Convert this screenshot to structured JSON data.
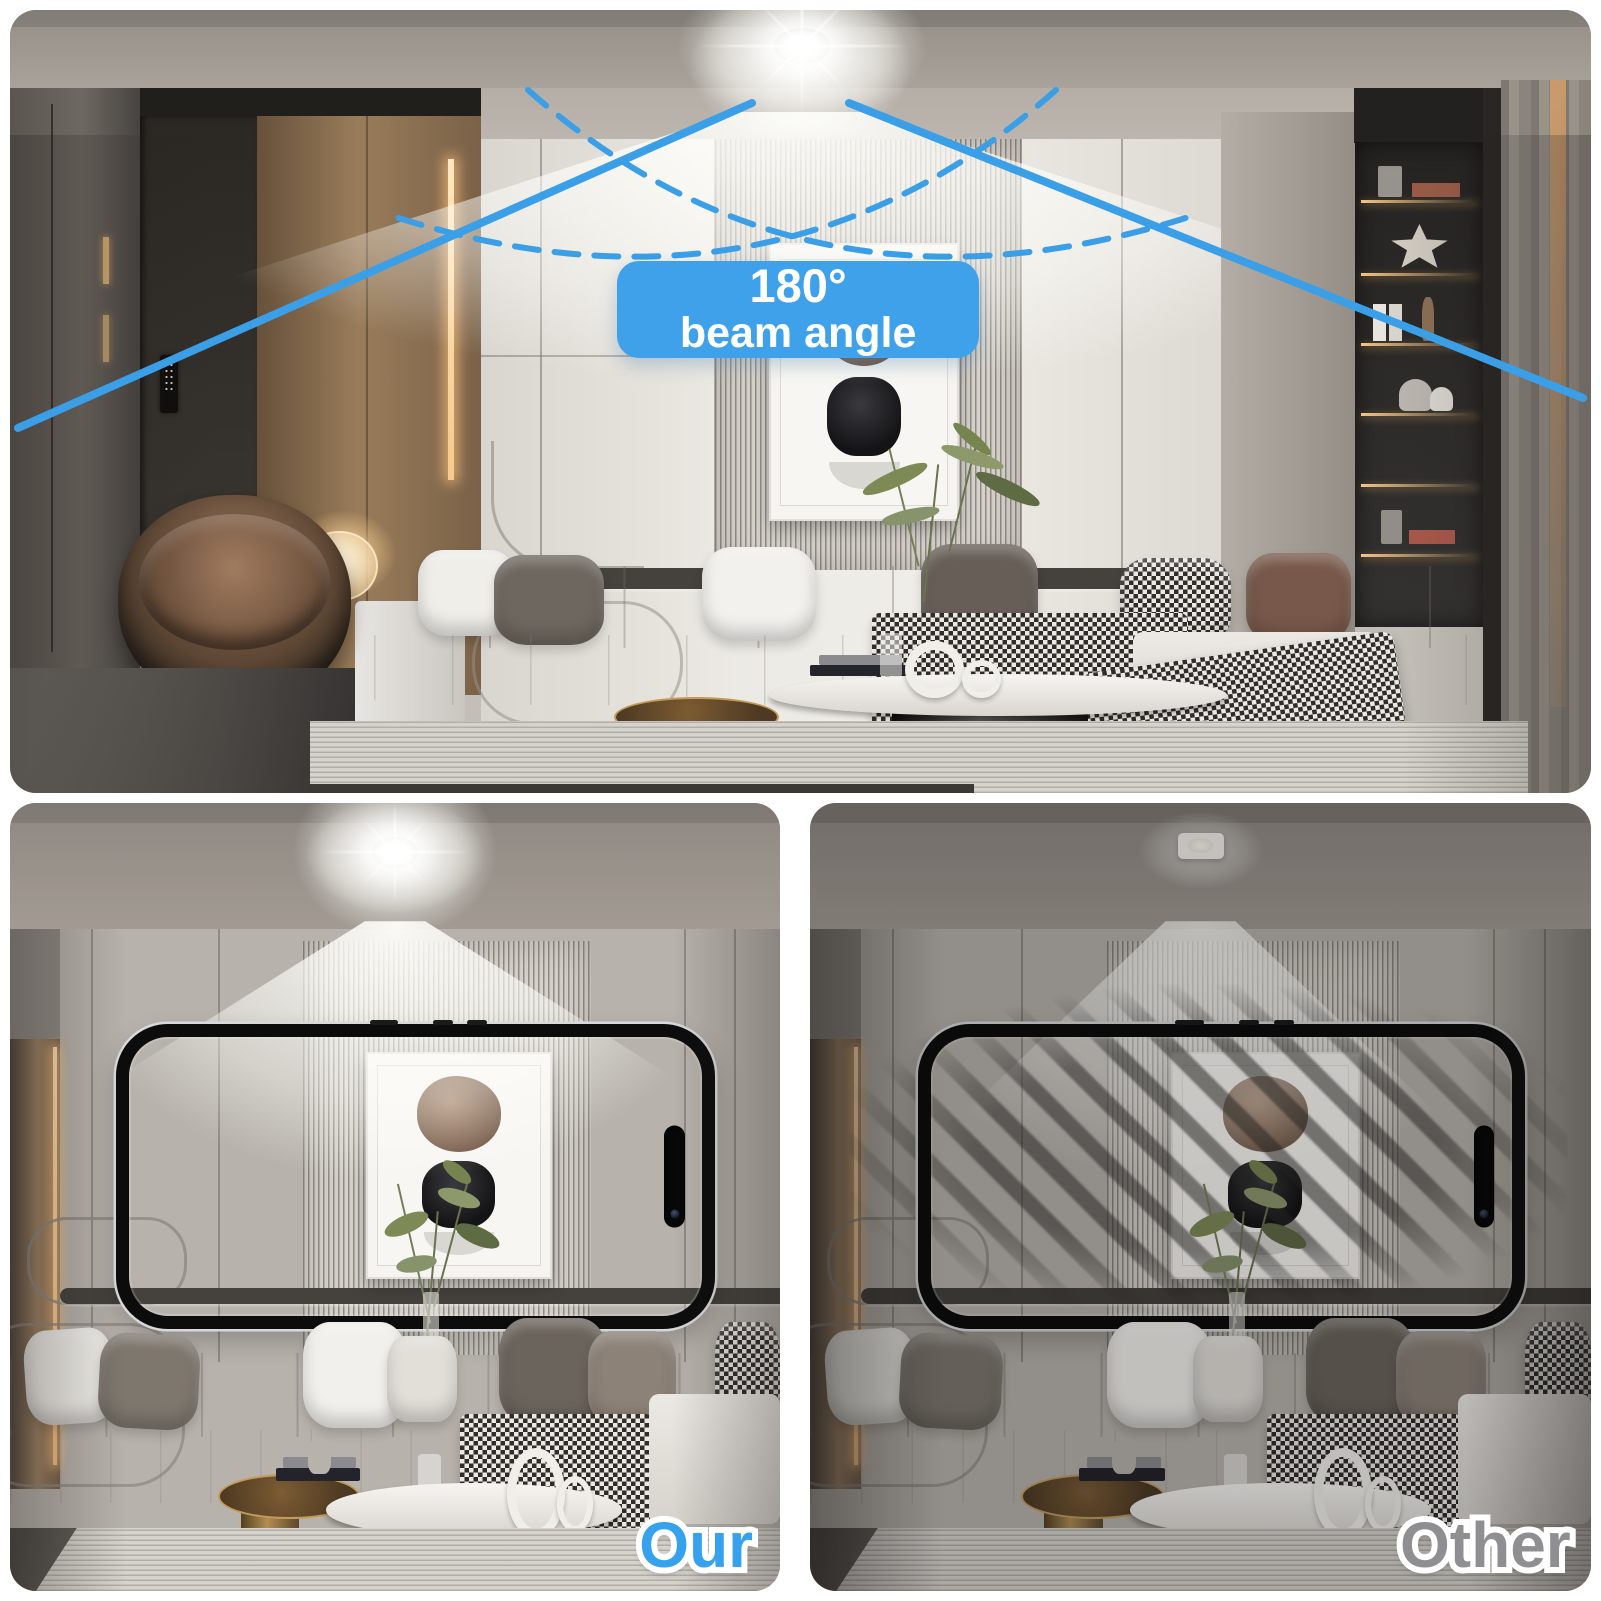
{
  "hero": {
    "badge": {
      "line_1": "180°",
      "line_2": "beam angle"
    },
    "badge_bg_color": "#3fa1e9",
    "beam_line_color": "#3b9fe8"
  },
  "comparison": {
    "our": {
      "label": "Our",
      "label_color": "#36a2ee"
    },
    "other": {
      "label": "Other",
      "label_color": "#8f8f91"
    }
  }
}
